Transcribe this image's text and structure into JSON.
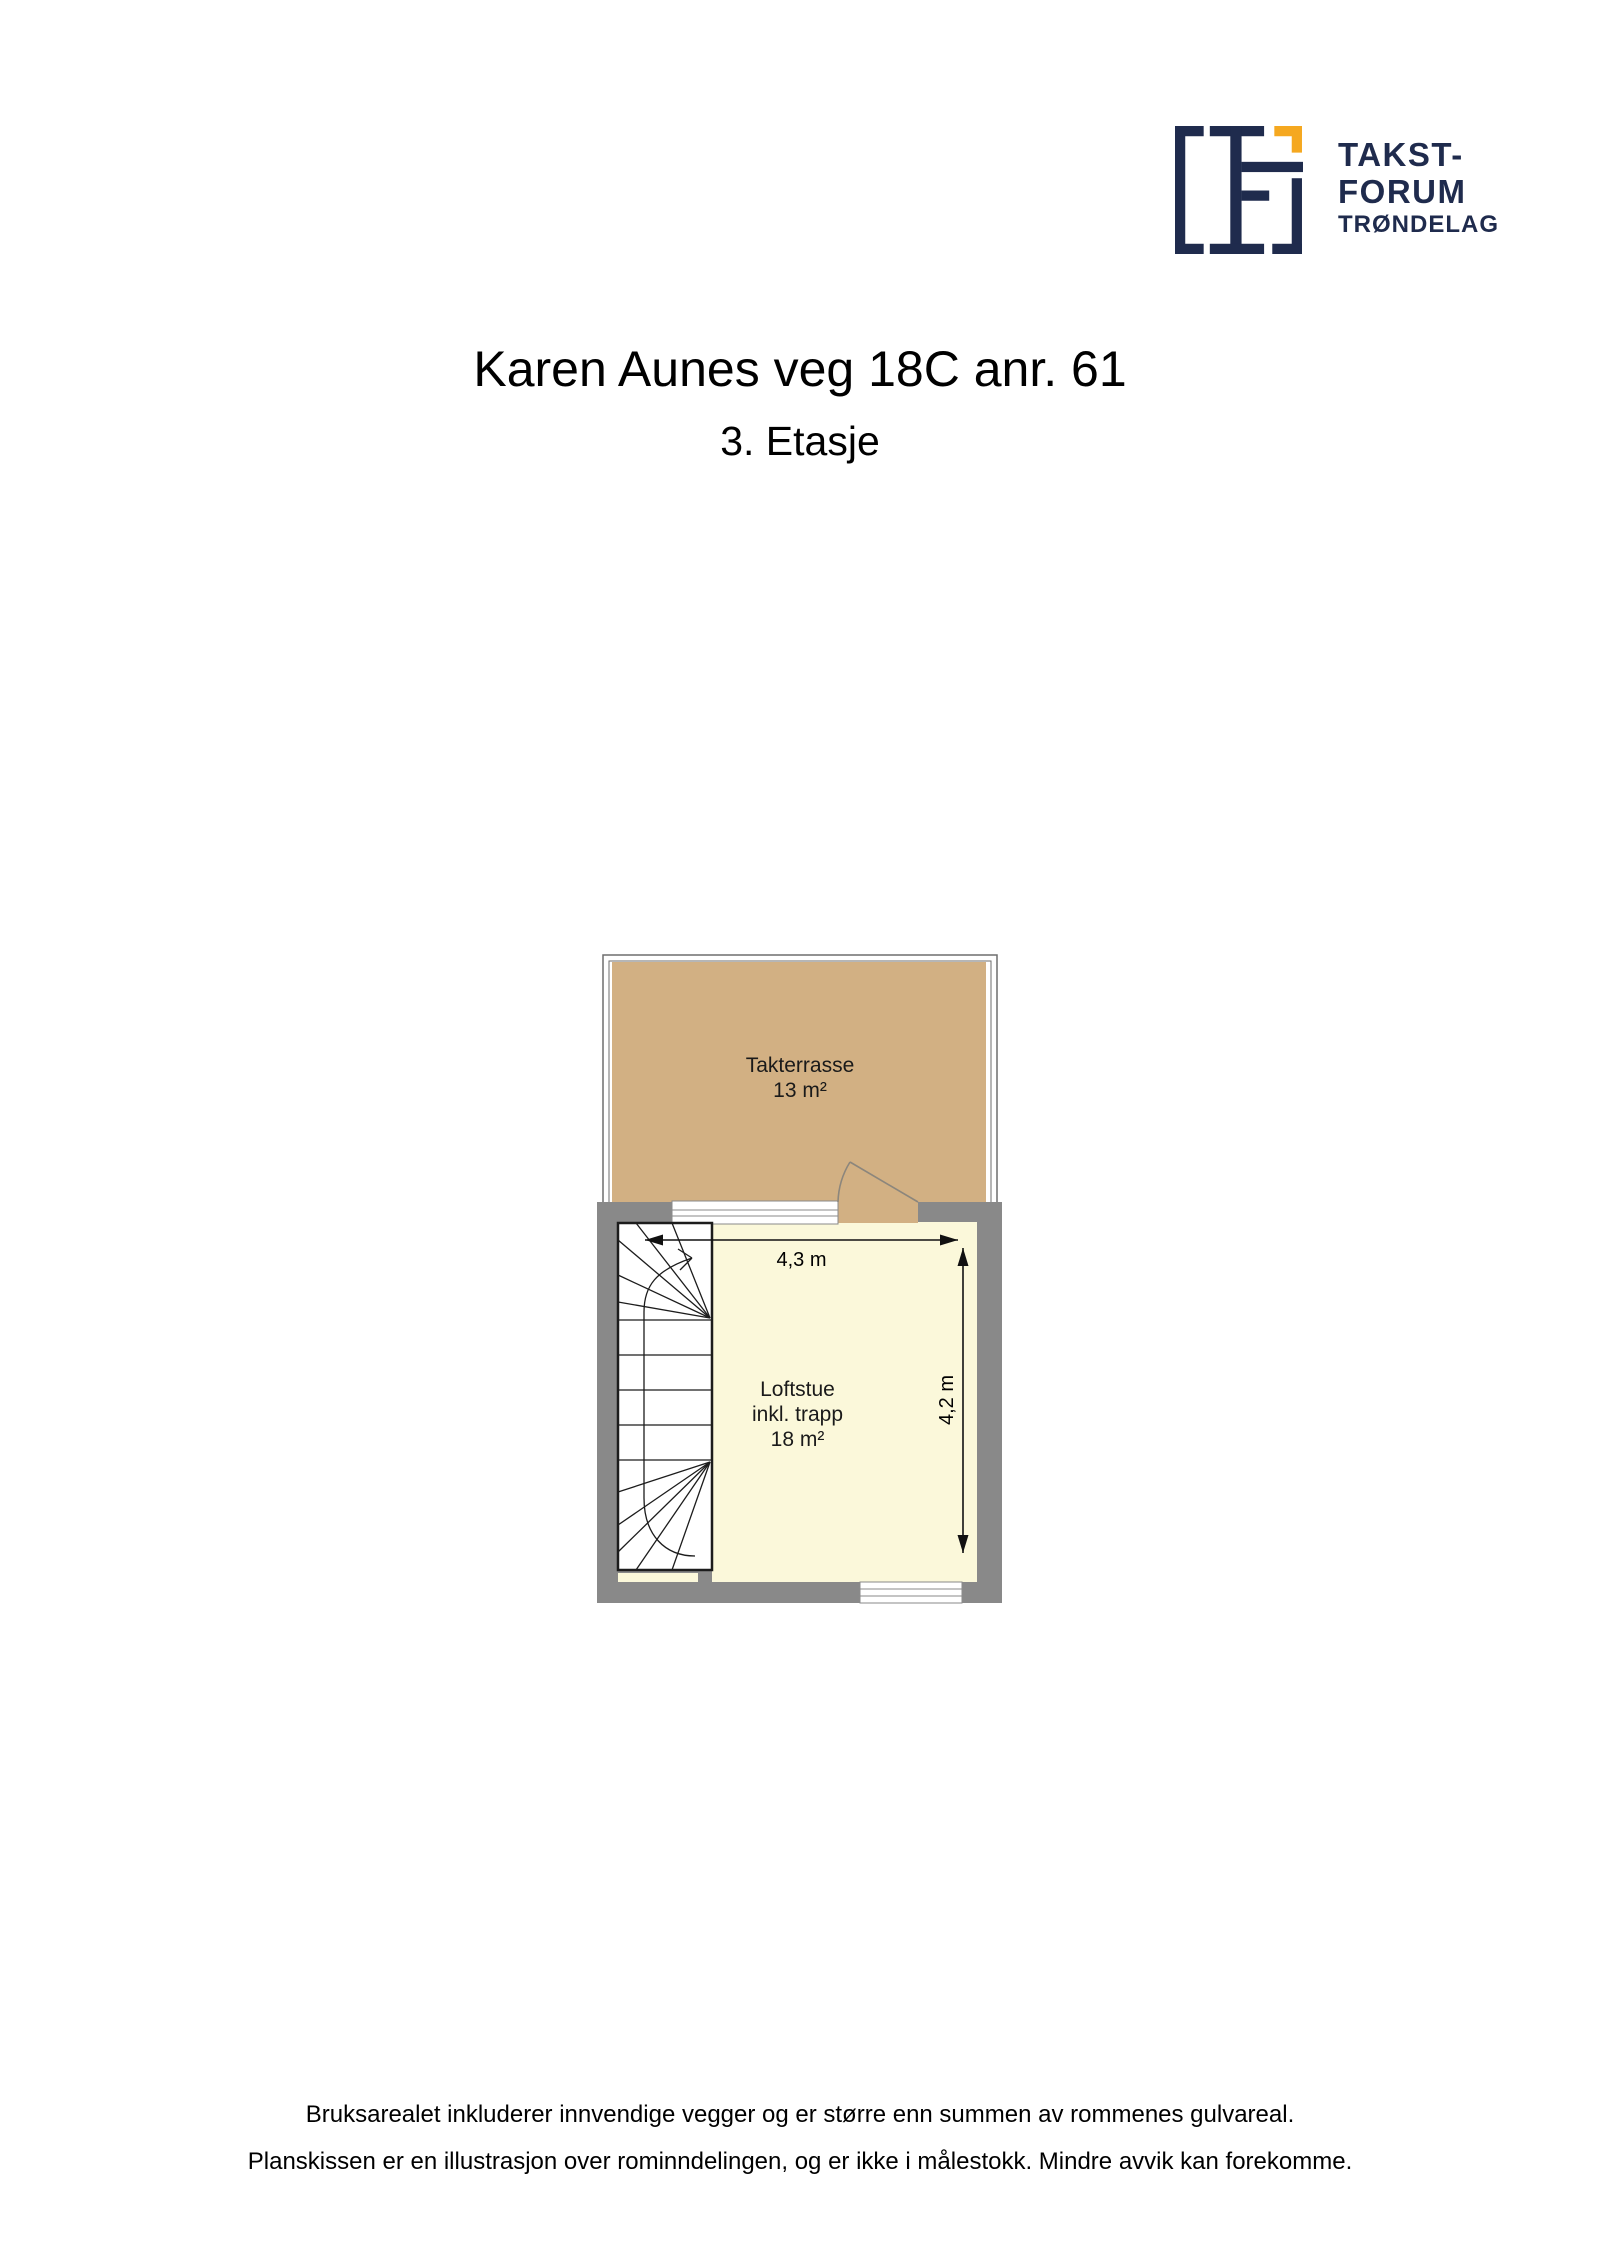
{
  "logo": {
    "brand_line1": "TAKST-",
    "brand_line2": "FORUM",
    "brand_line3": "TRØNDELAG",
    "navy": "#1f2b4d",
    "orange": "#f5a820"
  },
  "header": {
    "title": "Karen Aunes veg 18C anr. 61",
    "subtitle": "3. Etasje"
  },
  "floorplan": {
    "terrace": {
      "name": "Takterrasse",
      "area": "13 m²",
      "color": "#d2b083"
    },
    "room": {
      "name_line1": "Loftstue",
      "name_line2": "inkl. trapp",
      "area": "18 m²",
      "color": "#fbf8da"
    },
    "dim_width": "4,3 m",
    "dim_height": "4,2 m",
    "wall_color": "#898989"
  },
  "footer": {
    "line1": "Bruksarealet inkluderer innvendige vegger og er større enn summen av rommenes gulvareal.",
    "line2": "Planskissen er en illustrasjon over rominndelingen, og er ikke i målestokk. Mindre avvik kan forekomme."
  }
}
